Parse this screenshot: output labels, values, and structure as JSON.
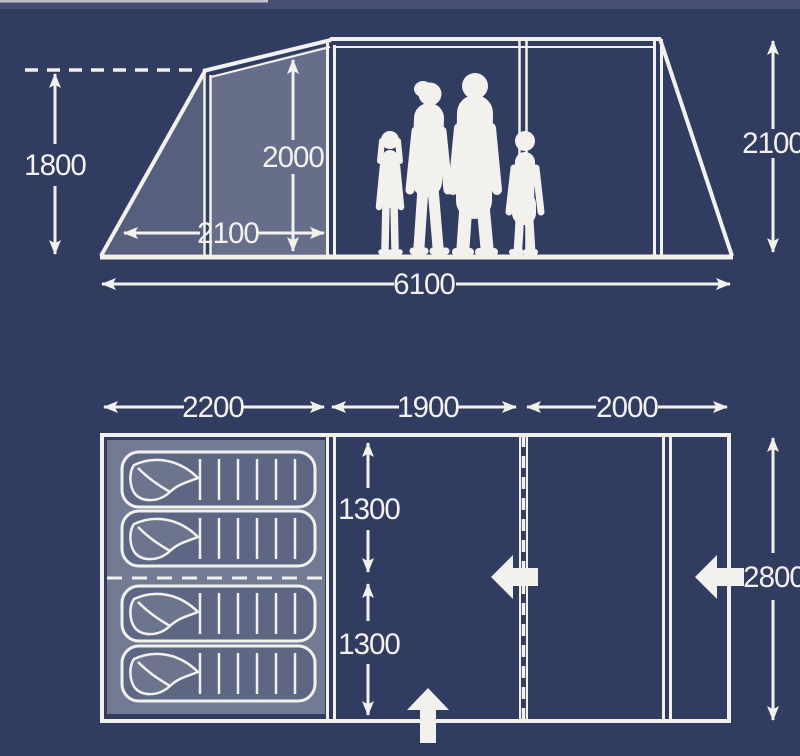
{
  "colors": {
    "background": "#313c61",
    "line_white": "#f2f1ed",
    "front_panel_shade": "rgba(255,255,255,0.26)",
    "front_triangle_shade": "rgba(255,255,255,0.18)",
    "bedroom_shade": "rgba(255,255,255,0.32)"
  },
  "side_view": {
    "dimensions": {
      "front_height": "1800",
      "inner_height": "2000",
      "front_depth": "2100",
      "total_length": "6100",
      "rear_height": "2100"
    },
    "figure_count": 4
  },
  "floor_plan": {
    "dimensions": {
      "bedroom_width": "2200",
      "middle_width": "1900",
      "front_width": "2000",
      "bedroom_depth_top": "1300",
      "bedroom_depth_bottom": "1300",
      "total_depth": "2800"
    },
    "berth_count": 4,
    "icons": [
      "sleeping-bag-icon",
      "door-arrow-icon"
    ]
  }
}
